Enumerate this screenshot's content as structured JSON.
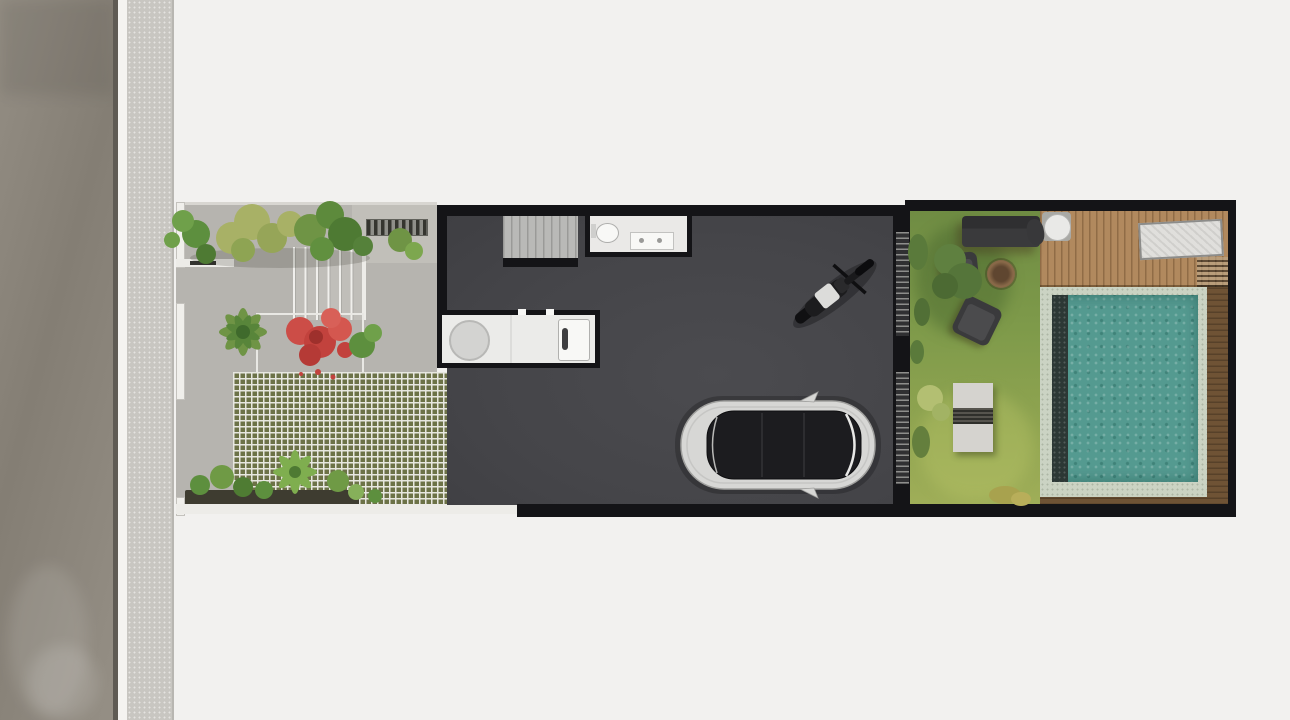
{
  "scene": {
    "type": "architectural-site-plan-rendering",
    "view": "top-down"
  },
  "palette": {
    "bg": "#f2f1ef",
    "road": "#8b857b",
    "curb-dark": "#5f5b54",
    "curb-white": "#f4f3f0",
    "sidewalk": "#c8c6c1",
    "paving": "#b6b4af",
    "paving-light": "#c1bfb9",
    "edge-white": "#edece8",
    "marker-dark": "#33332f",
    "step": "#c0beb9",
    "checker-green": "#6c7247",
    "checker-light": "#e7e7e0",
    "gravel": "#8e9087",
    "planter-dark": "#3e3c30",
    "wall": "#141417",
    "floor": "#47474a",
    "stair": "#b9b9b7",
    "stair-line": "#9a9a98",
    "room": "#eae9e7",
    "counter": "#ebebe9",
    "fixture-white": "#f8f8f6",
    "fixture-gray": "#d3d3d1",
    "grass": "#7e9a4a",
    "grass-light": "#9fae58",
    "grass-dark": "#55713a",
    "bush-olive": "#a8a24e",
    "leaf-light": "#a8b166",
    "leaf-mid": "#6f9445",
    "leaf-dark": "#4e7a33",
    "leaf-red": "#c2423d",
    "leaf-red-dark": "#9e302c",
    "deck": "#b1895e",
    "wood-dark": "#6f5335",
    "pool-tile": "#cbd3c3",
    "pool-water": "#549a90",
    "pool-ledge": "#2c3835",
    "furn-dark": "#3a3a3c",
    "bench": "#d5d3cf",
    "lounge-white": "#e0dfdc",
    "fire-ring": "#8a6a49",
    "fire-inner": "#5f4630",
    "car-body": "#d7d7d5",
    "car-glass": "#1c1c1f",
    "louver-light": "#8e8e8c",
    "louver-dark": "#303032",
    "moto-dark": "#1c1c1e",
    "moto-seat": "#dcdcda"
  },
  "labels": {
    "road": "road",
    "sidewalk": "sidewalk",
    "front-garden": "front garden with paving and planting",
    "entry-steps": "entry steps",
    "grass-pavers": "grass block paver driveway",
    "staircase": "staircase",
    "bathroom": "bathroom",
    "pantry": "pantry counter",
    "carport": "carport floor",
    "car": "car top view",
    "motorcycle": "motorcycle top view",
    "lawn": "rear lawn",
    "sofa": "outdoor sofa",
    "armchair-1": "armchair",
    "armchair-2": "armchair",
    "fire-pit": "fire pit",
    "garden-bench": "garden bench",
    "wood-deck": "wooden deck",
    "patio-table": "round patio table",
    "deck-chair": "deck chair",
    "sun-lounger": "sun lounger",
    "pool": "swimming pool",
    "pool-ledge": "pool ledge",
    "pool-surround": "pool wood surround",
    "screen": "slatted screen wall"
  }
}
